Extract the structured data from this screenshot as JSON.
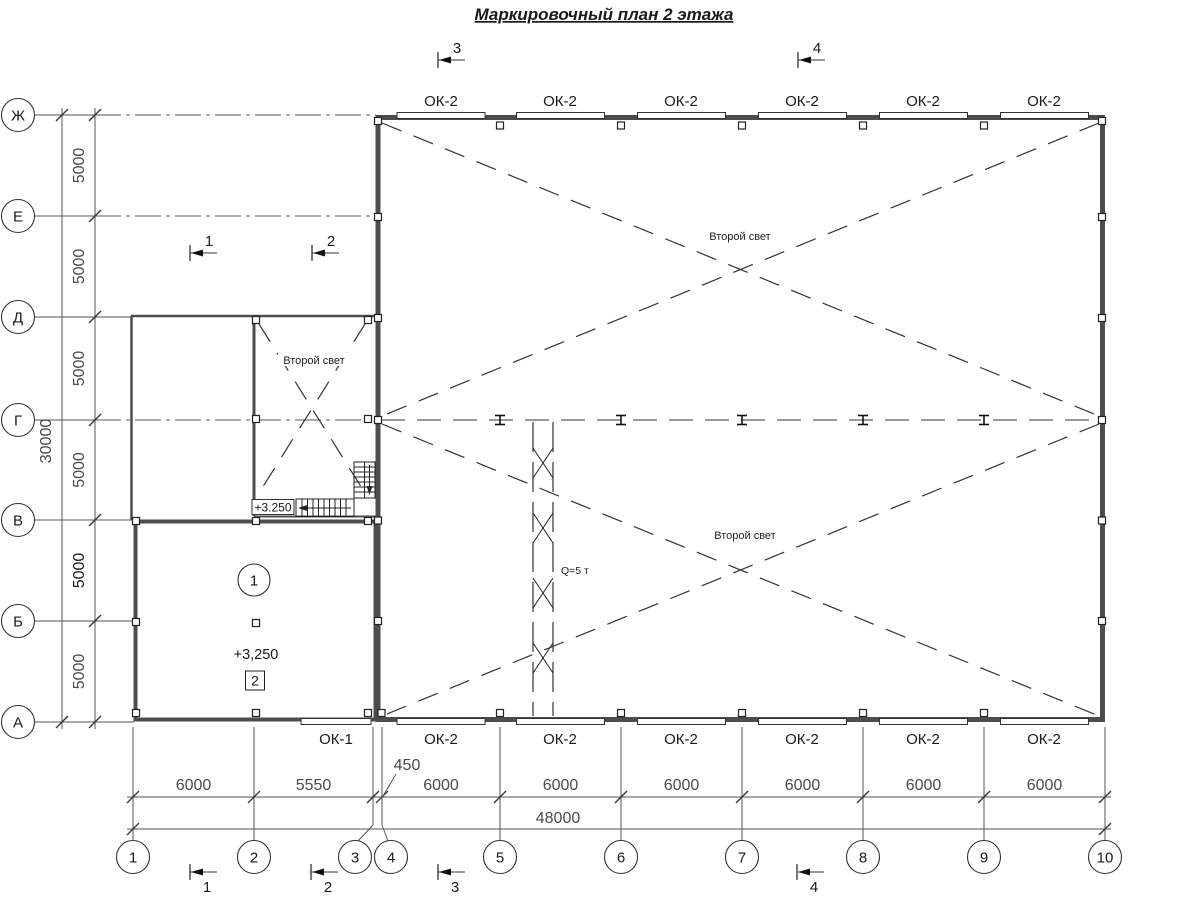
{
  "title": "Маркировочный план 2 этажа",
  "colors": {
    "line": "#333333",
    "wall": "#4d4d4d",
    "dim_text": "#4a4a4a"
  },
  "axes": {
    "rows": [
      "Ж",
      "Е",
      "Д",
      "Г",
      "В",
      "Б",
      "А"
    ],
    "cols": [
      "1",
      "2",
      "3",
      "4",
      "5",
      "6",
      "7",
      "8",
      "9",
      "10"
    ]
  },
  "dimensions": {
    "left_segments": [
      "5000",
      "5000",
      "5000",
      "5000",
      "5000",
      "5000"
    ],
    "left_total": "30000",
    "bottom_segments": [
      "6000",
      "5550",
      "6000",
      "6000",
      "6000",
      "6000",
      "6000",
      "6000"
    ],
    "bottom_offset": "450",
    "bottom_total": "48000"
  },
  "windows": {
    "top_labels": [
      "ОК-2",
      "ОК-2",
      "ОК-2",
      "ОК-2",
      "ОК-2",
      "ОК-2"
    ],
    "bottom_labels": [
      "ОК-1",
      "ОК-2",
      "ОК-2",
      "ОК-2",
      "ОК-2",
      "ОК-2",
      "ОК-2"
    ]
  },
  "annotations": {
    "second_light_upper": "Второй свет",
    "second_light_lower": "Второй свет",
    "second_light_annex": "Второй свет",
    "crane_capacity": "Q=5 т",
    "level_room": "+3,250",
    "level_stair": "+3.250",
    "room_tag_circle": "1",
    "room_tag_square": "2"
  },
  "section_markers": {
    "top": [
      "3",
      "4"
    ],
    "middle": [
      "1",
      "2"
    ],
    "bottom": [
      "1",
      "2",
      "3",
      "4"
    ]
  }
}
